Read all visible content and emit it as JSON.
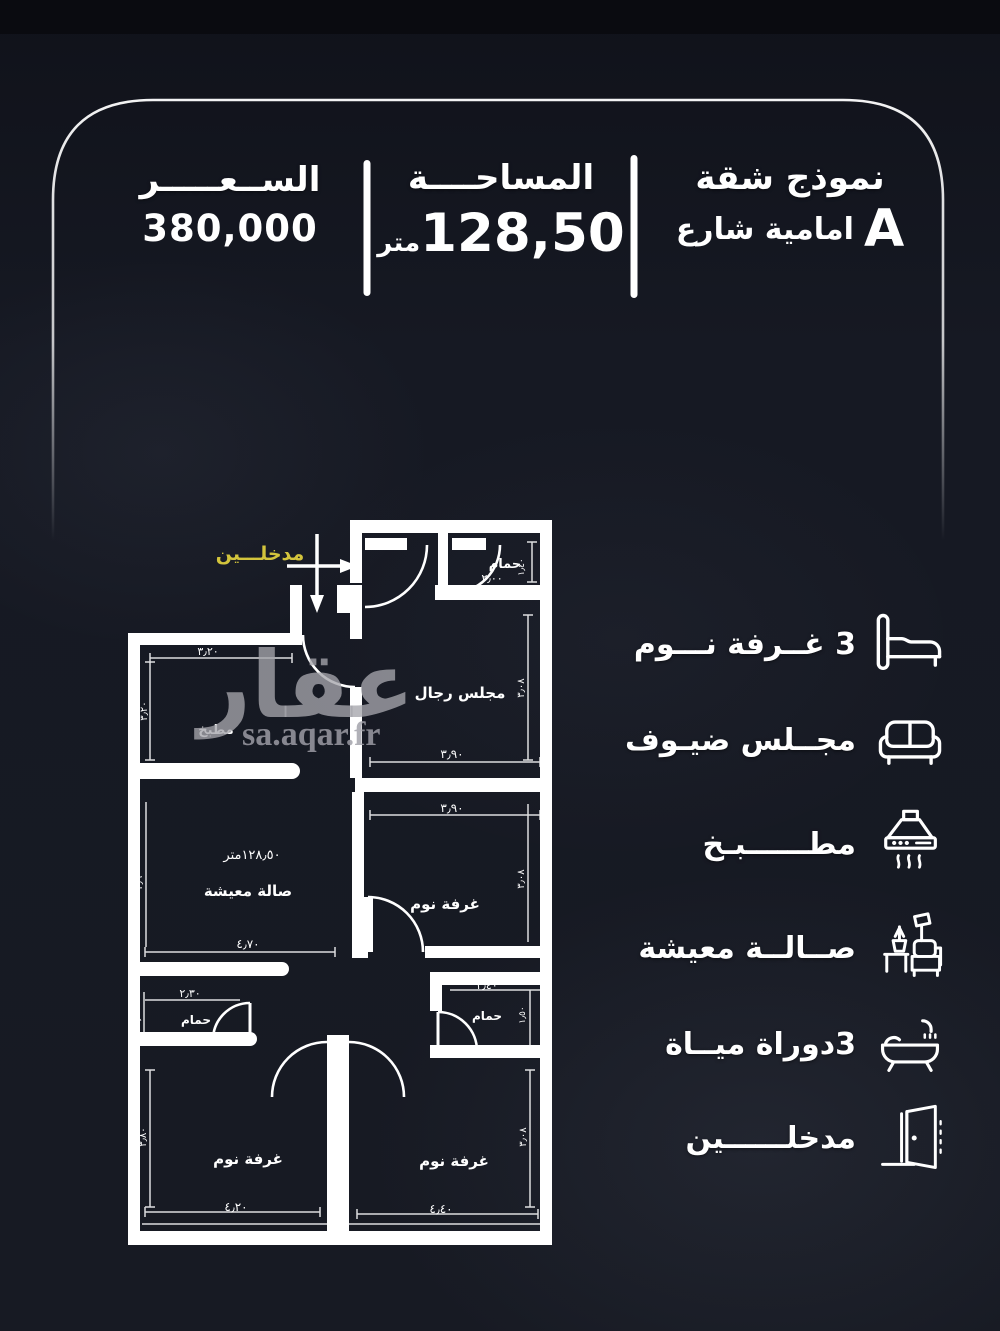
{
  "header": {
    "price": {
      "label": "الســعـــــر",
      "value": "380,000"
    },
    "area": {
      "label": "المساحــــة",
      "value": "128,50",
      "unit": "متر"
    },
    "model": {
      "label": "نموذج شقة",
      "letter": "A",
      "subtitle": "امامية شارع"
    }
  },
  "watermark": {
    "word": "عقار",
    "site": "sa.aqar.fr"
  },
  "features": [
    {
      "id": "bedrooms",
      "label": "3 غــرفة نـــوم",
      "icon": "bed-icon"
    },
    {
      "id": "guest-majlis",
      "label": "مجــلس ضيـوف",
      "icon": "sofa-icon"
    },
    {
      "id": "kitchen",
      "label": "مطــــــبـخ",
      "icon": "hood-icon"
    },
    {
      "id": "living-room",
      "label": "صــالــة معيشة",
      "icon": "living-room-icon"
    },
    {
      "id": "bathrooms",
      "label": "3دوراة ميــاة",
      "icon": "bathtub-icon"
    },
    {
      "id": "entrances",
      "label": "مدخلــــــين",
      "icon": "door-icon"
    }
  ],
  "plan": {
    "entrance": "مدخلـــين",
    "labels": {
      "bath_top": "حمام",
      "majlis": "مجلس رجال",
      "kitchen": "مطبخ",
      "living": "صالة معيشة",
      "living_area": "١٢٨٫٥٠متر",
      "bed_mid": "غرفة نوم",
      "bath_left": "حمام",
      "bath_right": "حمام",
      "bed_bottom_left": "غرفة نوم",
      "bed_bottom_right": "غرفة نوم"
    },
    "dims": {
      "bath_top_w": "٢٫٠٠",
      "bath_top_h": "١٫٤٠",
      "majlis_w": "٣٫٩٠",
      "majlis_h": "٣٫٠٨",
      "kitchen_w": "٣٫٢٠",
      "kitchen_h": "٣٫٢٠",
      "living_w": "٤٫٧٠",
      "living_h": "٣٫٦٠",
      "bed_mid_w": "٣٫٩٠",
      "bed_mid_h": "٣٫٠٨",
      "bath_left_w": "٢٫٣٠",
      "bath_left_h": "١٫٣٠",
      "bath_right_w": "٢٫٤٠",
      "bath_right_h": "١٫٥٠",
      "bed_bl_w": "٤٫٢٠",
      "bed_bl_h": "٣٫٨٠",
      "bed_br_w": "٤٫٤٠",
      "bed_br_h": "٣٫٠٨"
    },
    "colors": {
      "wall": "#ffffff",
      "entrance_label": "#d3c43c"
    }
  }
}
